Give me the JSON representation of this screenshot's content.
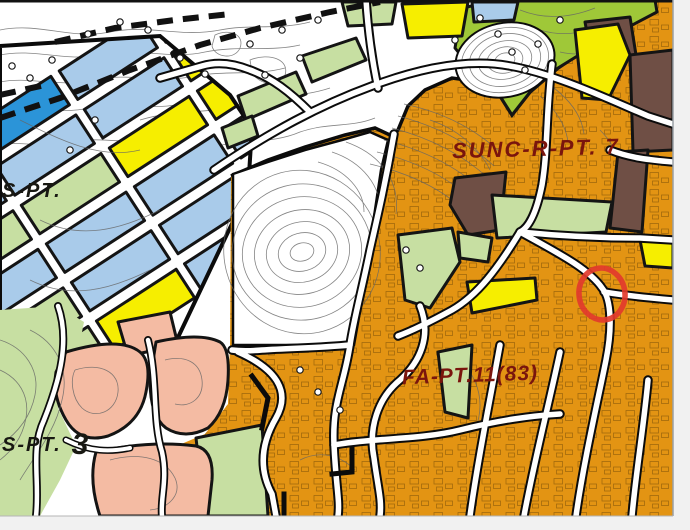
{
  "map": {
    "name": "urban-zoning-plan-map",
    "labels": {
      "sunc": {
        "text": "SUNC-R-PT. 7",
        "color": "#7a150d"
      },
      "fa": {
        "text": "FA-PT.11(83)",
        "color": "#7a150d"
      },
      "s_left": {
        "text": "S-PT.",
        "color": "#181812"
      },
      "s3_prefix": {
        "text": "S-PT.",
        "color": "#181812"
      },
      "s3_number": {
        "text": "3",
        "color": "#181812"
      }
    },
    "zone_colors": {
      "orange": "#E39413",
      "light_blue": "#A9CBEA",
      "bright_blue": "#2B94D8",
      "yellow": "#F6EE00",
      "light_green": "#C7DFA2",
      "green_belt": "#9FC838",
      "salmon": "#F4BBA3",
      "brown": "#6F4F45",
      "road": "#FFFFFF",
      "ink": "#0B0B0B",
      "contour": "#666666",
      "highlight_red": "#E23A2C",
      "outside": "#F1F1F1",
      "paper": "#FFFFFF"
    },
    "annotation": {
      "type": "highlight-circle"
    }
  }
}
